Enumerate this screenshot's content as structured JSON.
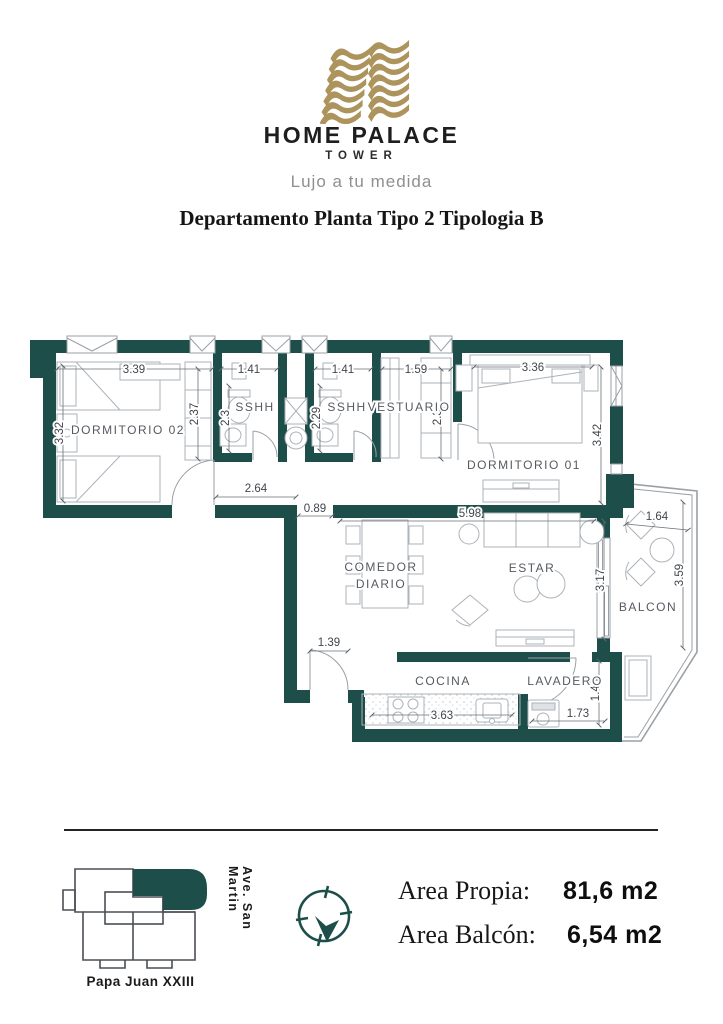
{
  "header": {
    "brand": "HOME PALACE",
    "brand_sub": "TOWER",
    "tagline": "Lujo a tu medida",
    "title": "Departamento Planta Tipo 2 Tipologia B"
  },
  "colors": {
    "wall_teal": "#1d4e4a",
    "logo_gold": "#ac945c"
  },
  "icons": {
    "logo": "stacked-gold-ribbons-building",
    "compass": "compass-north-arrow",
    "site_plan": "building-footprint-unit-highlight"
  },
  "plan": {
    "rooms": {
      "dorm02": "DORMITORIO 02",
      "sshh1": "SSHH",
      "sshh2": "SSHH",
      "vestuario": "VESTUARIO",
      "dorm01": "DORMITORIO 01",
      "comedor_l1": "COMEDOR",
      "comedor_l2": "DIARIO",
      "estar": "ESTAR",
      "balcon": "BALCON",
      "cocina": "COCINA",
      "lavadero": "LAVADERO"
    },
    "dims": {
      "d339": "3.39",
      "d141a": "1.41",
      "d141b": "1.41",
      "d159": "1.59",
      "d336": "3.36",
      "d332": "3.32",
      "d237a": "2.37",
      "d23": "2.3",
      "d229": "2.29",
      "d237b": "2.37",
      "d342": "3.42",
      "d264": "2.64",
      "d089": "0.89",
      "d598": "5.98",
      "d164": "1.64",
      "d359": "3.59",
      "d317": "3.17",
      "d139": "1.39",
      "d363": "3.63",
      "d173": "1.73",
      "d148": "1.48"
    }
  },
  "footer": {
    "street_bottom": "Papa Juan XXIII",
    "street_right": "Ave. San Martin",
    "area_propia_label": "Area Propia:",
    "area_propia_value": "81,6 m2",
    "area_balcon_label": "Area Balcón:",
    "area_balcon_value": "6,54 m2"
  }
}
